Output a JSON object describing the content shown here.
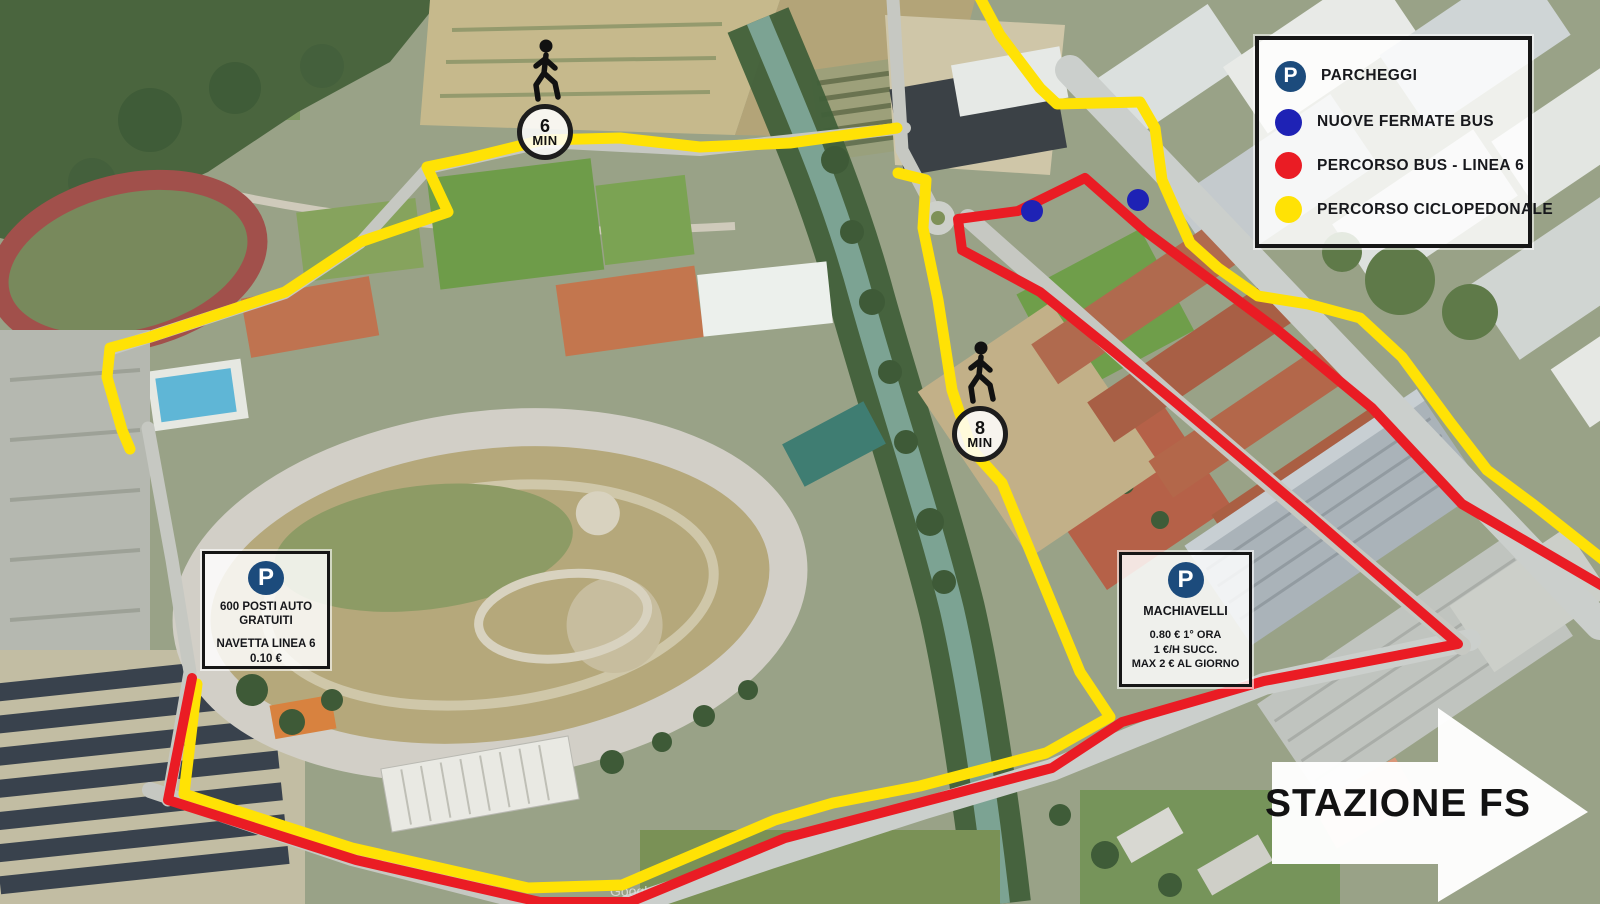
{
  "parking_symbol": "P",
  "legend": {
    "items": [
      {
        "icon": "parking-badge",
        "label": "PARCHEGGI",
        "color": "#1c4b7c"
      },
      {
        "icon": "dot",
        "label": "NUOVE FERMATE BUS",
        "color": "#1e22b5"
      },
      {
        "icon": "dot",
        "label": "PERCORSO BUS - LINEA 6",
        "color": "#ea1c24"
      },
      {
        "icon": "dot",
        "label": "PERCORSO CICLOPEDONALE",
        "color": "#ffe205"
      }
    ]
  },
  "parking_free": {
    "line1": "600 POSTI AUTO",
    "line2": "GRATUITI",
    "line3": "NAVETTA LINEA 6",
    "line4": "0.10 €"
  },
  "parking_machiavelli": {
    "name": "MACHIAVELLI",
    "rate1": "0.80 € 1° ORA",
    "rate2": "1 €/H SUCC.",
    "rate3": "MAX 2 € AL GIORNO"
  },
  "markers": {
    "walk6": {
      "value": "6",
      "unit": "MIN"
    },
    "walk8": {
      "value": "8",
      "unit": "MIN"
    }
  },
  "station_arrow": {
    "label": "STAZIONE FS"
  },
  "watermark": "Google",
  "route_colors": {
    "percorso_ciclopedonale": "#ffe205",
    "percorso_bus_linea6": "#ea1c24",
    "nuove_fermate_bus": "#1e22b5",
    "parcheggi_badge": "#1c4b7c"
  }
}
